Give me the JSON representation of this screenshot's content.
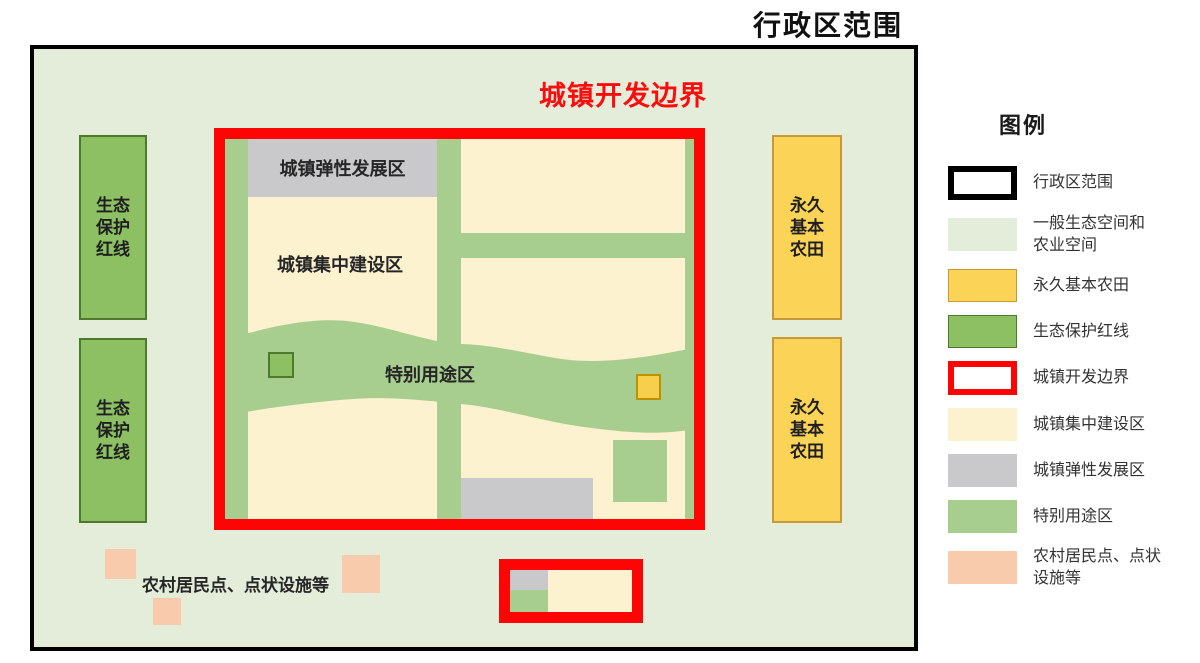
{
  "page": {
    "title": "行政区范围"
  },
  "boundary_title": "城镇开发边界",
  "map": {
    "eco_box_label": "生态\n保护\n红线",
    "farm_box_label": "永久\n基本\n农田",
    "flexible_zone_label": "城镇弹性发展区",
    "concentrated_zone_label": "城镇集中建设区",
    "special_zone_label": "特别用途区",
    "rural_label": "农村居民点、点状设施等"
  },
  "legend": {
    "title": "图例",
    "items": [
      {
        "swatch": "outline",
        "label": "行政区范围",
        "color": "#000000"
      },
      {
        "swatch": "fill",
        "label": "一般生态空间和\n农业空间",
        "color": "#e3edda"
      },
      {
        "swatch": "fill",
        "label": "永久基本农田",
        "color": "#fbd356"
      },
      {
        "swatch": "fill",
        "label": "生态保护红线",
        "color": "#8cc063"
      },
      {
        "swatch": "outline",
        "label": "城镇开发边界",
        "color": "#fe0505"
      },
      {
        "swatch": "fill",
        "label": "城镇集中建设区",
        "color": "#fdf2d0"
      },
      {
        "swatch": "fill",
        "label": "城镇弹性发展区",
        "color": "#c9c9cb"
      },
      {
        "swatch": "fill",
        "label": "特别用途区",
        "color": "#a7ce8e"
      },
      {
        "swatch": "fill",
        "label": "农村居民点、点状\n设施等",
        "color": "#f8cbad"
      }
    ]
  },
  "colors": {
    "admin_fill": "#e3edda",
    "admin_border": "#000000",
    "boundary_red": "#fe0505",
    "boundary_title_red": "#fb0d0d",
    "urban_cream": "#fdf2d0",
    "flexible_gray": "#c9c9cb",
    "special_green": "#a7ce8e",
    "eco_green_fill": "#8cc063",
    "eco_green_border": "#4e7a2b",
    "farm_yellow_fill": "#fbd356",
    "farm_yellow_border": "#c7993b",
    "small_yellow_fill": "#f8ce4d",
    "small_yellow_border": "#bf9000",
    "rural_salmon": "#f8cbad"
  }
}
